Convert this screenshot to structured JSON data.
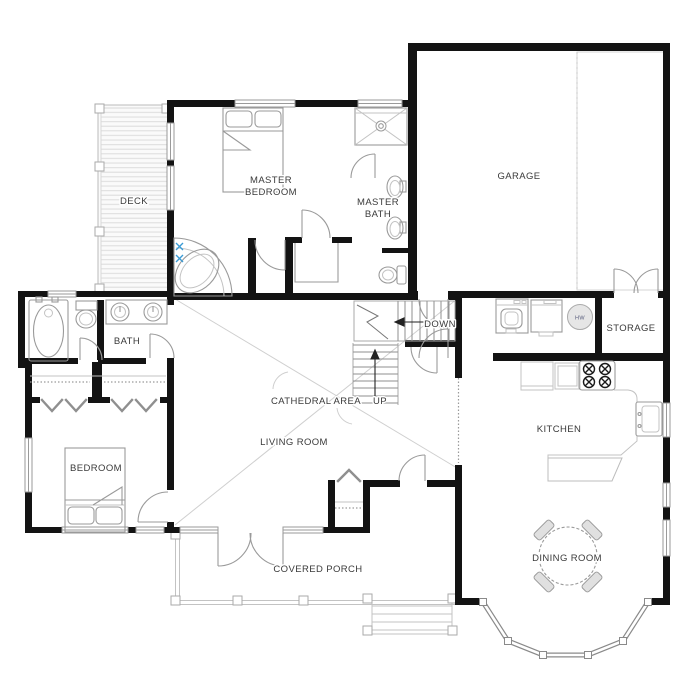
{
  "title": "House Floor Plan",
  "labels": {
    "deck": "DECK",
    "master_bedroom_1": "MASTER",
    "master_bedroom_2": "BEDROOM",
    "master_bath_1": "MASTER",
    "master_bath_2": "BATH",
    "garage": "GARAGE",
    "storage": "STORAGE",
    "bath": "BATH",
    "down": "DOWN",
    "up": "UP",
    "cathedral_area": "CATHEDRAL AREA",
    "living_room": "LIVING ROOM",
    "bedroom": "BEDROOM",
    "kitchen": "KITCHEN",
    "dining_room": "DINING ROOM",
    "covered_porch": "COVERED PORCH",
    "water_heater": "HW"
  },
  "colors": {
    "wall": "#131313",
    "fixture": "#9a9a9a",
    "light_line": "#cccccc",
    "label": "#3a3a3a",
    "faucet_accent": "#3a9bd5"
  }
}
